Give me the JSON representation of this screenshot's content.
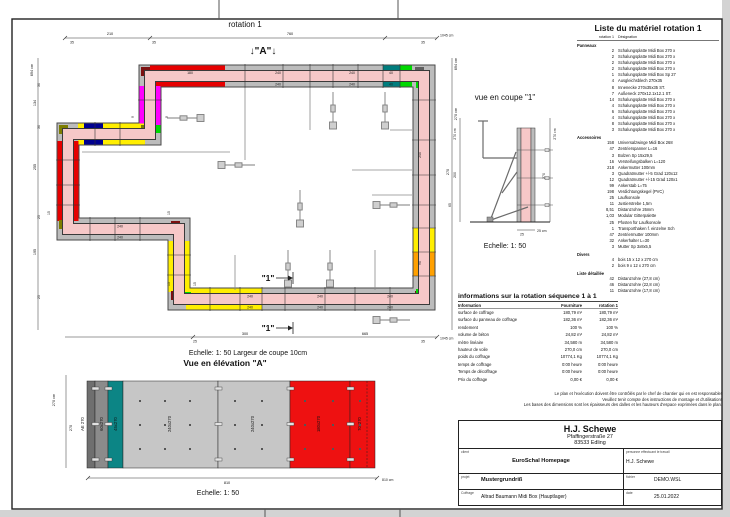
{
  "colors": {
    "wall": "#f6c8c8",
    "panel": "#bcbcbc",
    "red": "#e60000",
    "yellow": "#ffee00",
    "green": "#00d800",
    "magenta": "#ff00ff",
    "dark_red": "#7c1010",
    "navy": "#000090",
    "teal": "#007d7d",
    "olive": "#7d7d00",
    "orange": "#ffa000",
    "dark_gray": "#5f5f5f",
    "elev_dark": "#6f6f6f",
    "elev_gray": "#8b8b8b",
    "elev_teal": "#0c8585",
    "elev_light": "#c6c6c6",
    "elev_red": "#ee1111"
  },
  "plan": {
    "title": "rotation 1",
    "section_a_marker": "↓\"A\"↓",
    "section_1_marker": "\"1\"",
    "scale_note": "Echelle: 1: 50   Largeur de coupe 10cm",
    "dims": {
      "top": [
        "35",
        "210",
        "35",
        "760",
        "35",
        "1045 cm"
      ],
      "left": [
        "694 cm",
        "30",
        "134",
        "30",
        "255",
        "25",
        "195",
        "25"
      ],
      "right": [
        "694 cm",
        "270 cm",
        "270"
      ],
      "bottom": [
        "25",
        "300",
        "665",
        "35",
        "1045 cm"
      ],
      "misc": [
        "15",
        "15",
        "9",
        "9",
        "15",
        "15"
      ]
    },
    "panel_labels": [
      "180",
      "240",
      "240",
      "40",
      "240",
      "240",
      "40",
      "240",
      "90",
      "240",
      "240",
      "240",
      "240",
      "240",
      "240",
      "240",
      "240"
    ]
  },
  "coupe": {
    "title": "vue en coupe \"1\"",
    "scale": "Echelle: 1: 50",
    "dims": {
      "left_total": "270 cm",
      "left_mid": "200",
      "left_low": "65",
      "right_total": "270 cm",
      "right_inner": "270",
      "bottom": "25 cm",
      "bottom_tick": "25"
    }
  },
  "elevation": {
    "title": "Vue en élévation \"A\"",
    "scale": "Echelle: 1: 50",
    "dims": {
      "left_total": "270 cm",
      "left_inner": "270",
      "bottom_inner": "810",
      "bottom_total": "810 cm"
    },
    "panels": [
      "AE 270",
      "60x270",
      "45x270",
      "240x270",
      "240x270",
      "180x270",
      "70x270"
    ]
  },
  "materials": {
    "title": "Liste du matériel  rotation 1",
    "col_qty": "rotation 1",
    "col_name": "Désignation",
    "sec_panneaux": "Panneaux",
    "sec_accessoires": "Accessoires",
    "sec_divers": "Divers",
    "sec_detail": "Liste détaillée",
    "panneaux": [
      {
        "q": "2",
        "t": "Schalungsplatte Midi Box 270 x"
      },
      {
        "q": "2",
        "t": "Schalungsplatte Midi Box 270 x"
      },
      {
        "q": "2",
        "t": "Schalungsplatte Midi Box 270 x"
      },
      {
        "q": "2",
        "t": "Schalungsplatte Midi Box 270 x"
      },
      {
        "q": "1",
        "t": "Schalungsplatte Midi Box Sp 27"
      },
      {
        "q": "4",
        "t": "Ausgleichsblech 270x35"
      },
      {
        "q": "8",
        "t": "Innenecke 270x35x35 ST."
      },
      {
        "q": "7",
        "t": "Außeneck 270x12.1x12.1 ST."
      },
      {
        "q": "14",
        "t": "Schalungsplatte Midi Box 270 x"
      },
      {
        "q": "4",
        "t": "Schalungsplatte Midi Box 270 x"
      },
      {
        "q": "6",
        "t": "Schalungsplatte Midi Box 270 x"
      },
      {
        "q": "4",
        "t": "Schalungsplatte Midi Box 270 x"
      },
      {
        "q": "8",
        "t": "Schalungsplatte Midi Box 270 x"
      },
      {
        "q": "3",
        "t": "Schalungsplatte Midi Box 270 x"
      }
    ],
    "accessoires": [
      {
        "q": "158",
        "t": "Universalzwinge Midi Box 268"
      },
      {
        "q": "47",
        "t": "Zentrierspanner L=16"
      },
      {
        "q": "3",
        "t": "Bolzen Sp 15x29,5"
      },
      {
        "q": "16",
        "t": "Versteifungsbalken L=120"
      },
      {
        "q": "218",
        "t": "Ankermutter 100mm"
      },
      {
        "q": "3",
        "t": "Quadratmutter +/-5 Grad 120x12"
      },
      {
        "q": "12",
        "t": "Quadratmutter +/-15 Grad 120x1"
      },
      {
        "q": "99",
        "t": "Ankerstab L=75"
      },
      {
        "q": "198",
        "t": "Verdichtungskegel (PVC)"
      },
      {
        "q": "25",
        "t": "Laufkonsole"
      },
      {
        "q": "11",
        "t": "Justierstrebe 1,5m"
      },
      {
        "q": "8,51",
        "t": "Distanzrohre 26mm"
      },
      {
        "q": "1,03",
        "t": "Modular Gitterpalette"
      },
      {
        "q": "25",
        "t": "Pfosten für Laufkonsole"
      },
      {
        "q": "1",
        "t": "Transporthaken f. einzelne Sch"
      },
      {
        "q": "47",
        "t": "Zentriermutter 100mm"
      },
      {
        "q": "32",
        "t": "Ankerhalter L=30"
      },
      {
        "q": "3",
        "t": "Mutter Sp 3x8x5,5"
      }
    ],
    "divers": [
      {
        "q": "4",
        "t": "bois 15 x 12 x 270 cm"
      },
      {
        "q": "2",
        "t": "bois 9 x 12 x 270 cm"
      }
    ],
    "detail": [
      {
        "q": "42",
        "t": "Distanzrohre  (27,8 cm)"
      },
      {
        "q": "46",
        "t": "Distanzrohre  (22,8 cm)"
      },
      {
        "q": "11",
        "t": "Distanzrohre  (17,8 cm)"
      }
    ]
  },
  "info": {
    "title": "informations sur la rotation  séquence 1 à 1",
    "col_info": "Information",
    "col_fourniture": "Fourniture",
    "col_rotation": "rotation 1",
    "rows": [
      {
        "l": "surface de coffrage",
        "f": "180,79 m²",
        "r": "180,79 m²"
      },
      {
        "l": "surface du panneau de coffrage",
        "f": "182,36 m²",
        "r": "182,36 m²"
      },
      {
        "l": "rendement",
        "f": "100 %",
        "r": "100 %"
      },
      {
        "l": "volume de béton",
        "f": "24,82 m³",
        "r": "24,82 m³"
      },
      {
        "l": "mètre linéaire",
        "f": "34,580 m",
        "r": "34,580 m"
      },
      {
        "l": "hauteur de voile",
        "f": "270,0 cm",
        "r": "270,0 cm"
      },
      {
        "l": "poids du coffrage",
        "f": "10774,1 Kg",
        "r": "10774,1 Kg"
      },
      {
        "l": "temps de coffrage",
        "f": "0:00 heure",
        "r": "0:00 heure"
      },
      {
        "l": "Temps de décoffrage",
        "f": "0:00 heure",
        "r": "0:00 heure"
      },
      {
        "l": "Prix du coffrage",
        "f": "0,00 €",
        "r": "0,00 €"
      }
    ]
  },
  "disclaimer": {
    "line1": "Le plan et l'exécution doivent être contrôlés par le chef de chantier qui en est responsable!",
    "line2": "Veuillez tenir compte des instructions de montage et d'utilisation!",
    "line3": "Les bases des dimensions sont les épaisseurs des dalles et les hauteurs d'espace exprimées dans le plan."
  },
  "titleblock": {
    "company": "H.J. Schewe",
    "address1": "Pfaffingerstraße 27",
    "address2": "83533 Edling",
    "client_label": "client",
    "client": "EuroSchal Homepage",
    "worker_label": "personne effectuant le travail",
    "worker": "H.J. Schewe",
    "project_label": "projet",
    "project": "Mustergrundriß",
    "file_label": "fichier",
    "file": "DEMO.WSL",
    "formwork_label": "Coffrage",
    "formwork": "Altrad Baumann Midi Box (Hauptlager)",
    "date_label": "date",
    "date": "25.01.2022"
  }
}
